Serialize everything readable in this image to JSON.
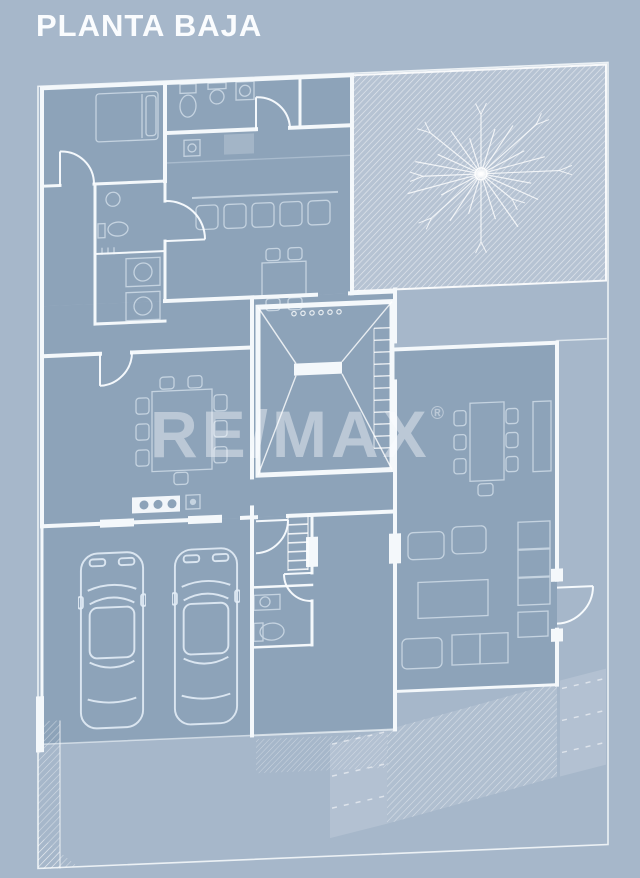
{
  "header": {
    "title": "PLANTA BAJA"
  },
  "watermark": {
    "brand": "RE/MAX",
    "registered_mark": "®"
  },
  "colors": {
    "background": "#a6b7ca",
    "room_fill": "#8da3b9",
    "garden_fill": "#b6c3d3",
    "wall": "#f4f8fb",
    "furniture_line": "#c8d6e3",
    "title_text": "#fafcfe",
    "watermark_text": "rgba(250,253,255,0.42)"
  }
}
